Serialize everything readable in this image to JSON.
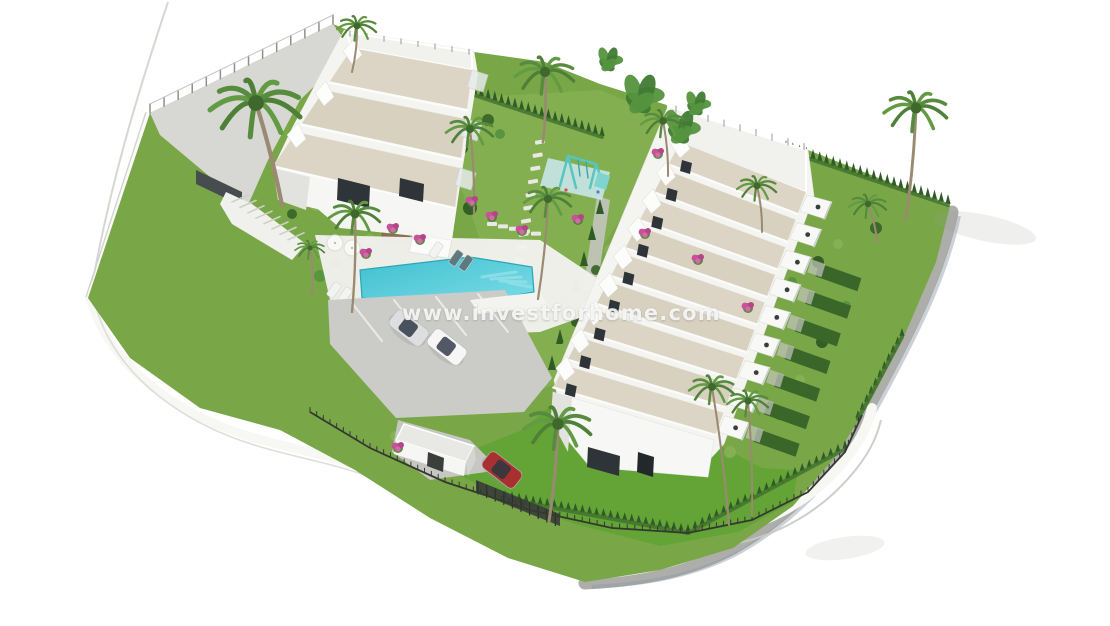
{
  "page": {
    "background": "#ffffff",
    "type": "3D aerial architectural render of a new-build residential development"
  },
  "watermark": {
    "text": "www.investforhome.com",
    "color": "#ffffff"
  },
  "scene": {
    "label": "Aerial view of residential complex with townhouses, villas, communal pool, playground, gardens and parking",
    "buildings": {
      "townhouse_row": {
        "label": "Terraced townhouse row",
        "units": 9,
        "roof_color": "#dcd5c5"
      },
      "villa_block": {
        "label": "Villa block",
        "units": 3,
        "roof_color": "#dcd5c5"
      },
      "gatehouse": {
        "label": "Entrance gatehouse"
      }
    },
    "amenities": {
      "pool": {
        "label": "Communal swimming pool"
      },
      "playground": {
        "label": "Children's playground"
      },
      "parking": {
        "label": "Parking area",
        "cars": [
          "silver",
          "white"
        ]
      },
      "gardens": {
        "label": "Landscaped gardens with palm trees and hedges"
      },
      "road": {
        "label": "Curved perimeter road"
      }
    },
    "vehicles": {
      "parked_red_car": "#a93030"
    },
    "colors": {
      "lawn": "#79a748",
      "lawn_bright": "#64a436",
      "lawn_light": "#86b054",
      "hedge": "#3a6629",
      "cypress": "#2f5b26",
      "roof_sand": "#dcd5c5",
      "wall_white": "#f6f6f4",
      "wall_shadow": "#e2e2de",
      "window_dark": "#2e3438",
      "paving": "#d7d7d3",
      "parking": "#cbcbc7",
      "walkway": "#adada9",
      "pool_water": "#45c5d4",
      "pool_light": "#8fdfe7",
      "deck": "#f1f1ed",
      "car_silver": "#dcdee0",
      "car_white": "#f6f6f7",
      "car_red": "#a93030",
      "playground_teal": "#58c5bf",
      "playground_pad": "#c8e6e9",
      "flower_pink": "#c9509b",
      "palm_frond": "#578b3d",
      "palm_trunk": "#9a8a72",
      "fence_dark": "#34392f",
      "stone_wall": "#8a6f52",
      "road_line": "#d6d6d2",
      "curb_white": "#f7f7f4"
    }
  }
}
